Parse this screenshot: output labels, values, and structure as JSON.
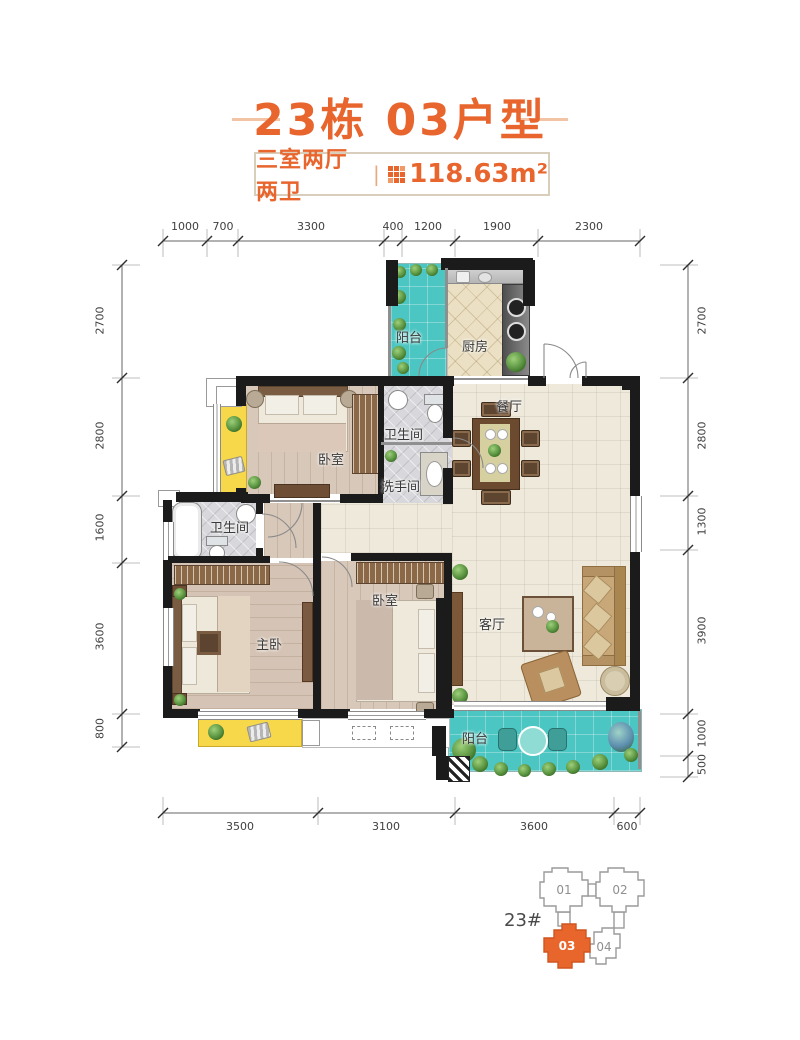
{
  "header": {
    "title": "23栋 03户型",
    "spec": "三室两厅两卫",
    "divider": "|",
    "area": "118.63m²"
  },
  "dimensions": {
    "top": [
      "1000",
      "700",
      "3300",
      "400",
      "1200",
      "1900",
      "2300"
    ],
    "bottom": [
      "3500",
      "3100",
      "3600",
      "600"
    ],
    "left": [
      "2700",
      "2800",
      "1600",
      "3600",
      "800"
    ],
    "right": [
      "2700",
      "2800",
      "1300",
      "3900",
      "1000",
      "500"
    ]
  },
  "rooms": {
    "balcony_top": "阳台",
    "kitchen": "厨房",
    "dining": "餐厅",
    "bedroom_top": "卧室",
    "bath_top": "卫生间",
    "washroom": "洗手间",
    "bath_master": "卫生间",
    "master": "主卧",
    "bedroom_second": "卧室",
    "living": "客厅",
    "balcony_bottom": "阳台"
  },
  "building_key": {
    "label": "23#",
    "units": [
      {
        "id": "01"
      },
      {
        "id": "02"
      },
      {
        "id": "03"
      },
      {
        "id": "04"
      }
    ]
  },
  "colors": {
    "accent": "#e8652e",
    "balcony": "#4cc6c2",
    "bay_window": "#f7d84b",
    "wall": "#1b1b1b"
  }
}
